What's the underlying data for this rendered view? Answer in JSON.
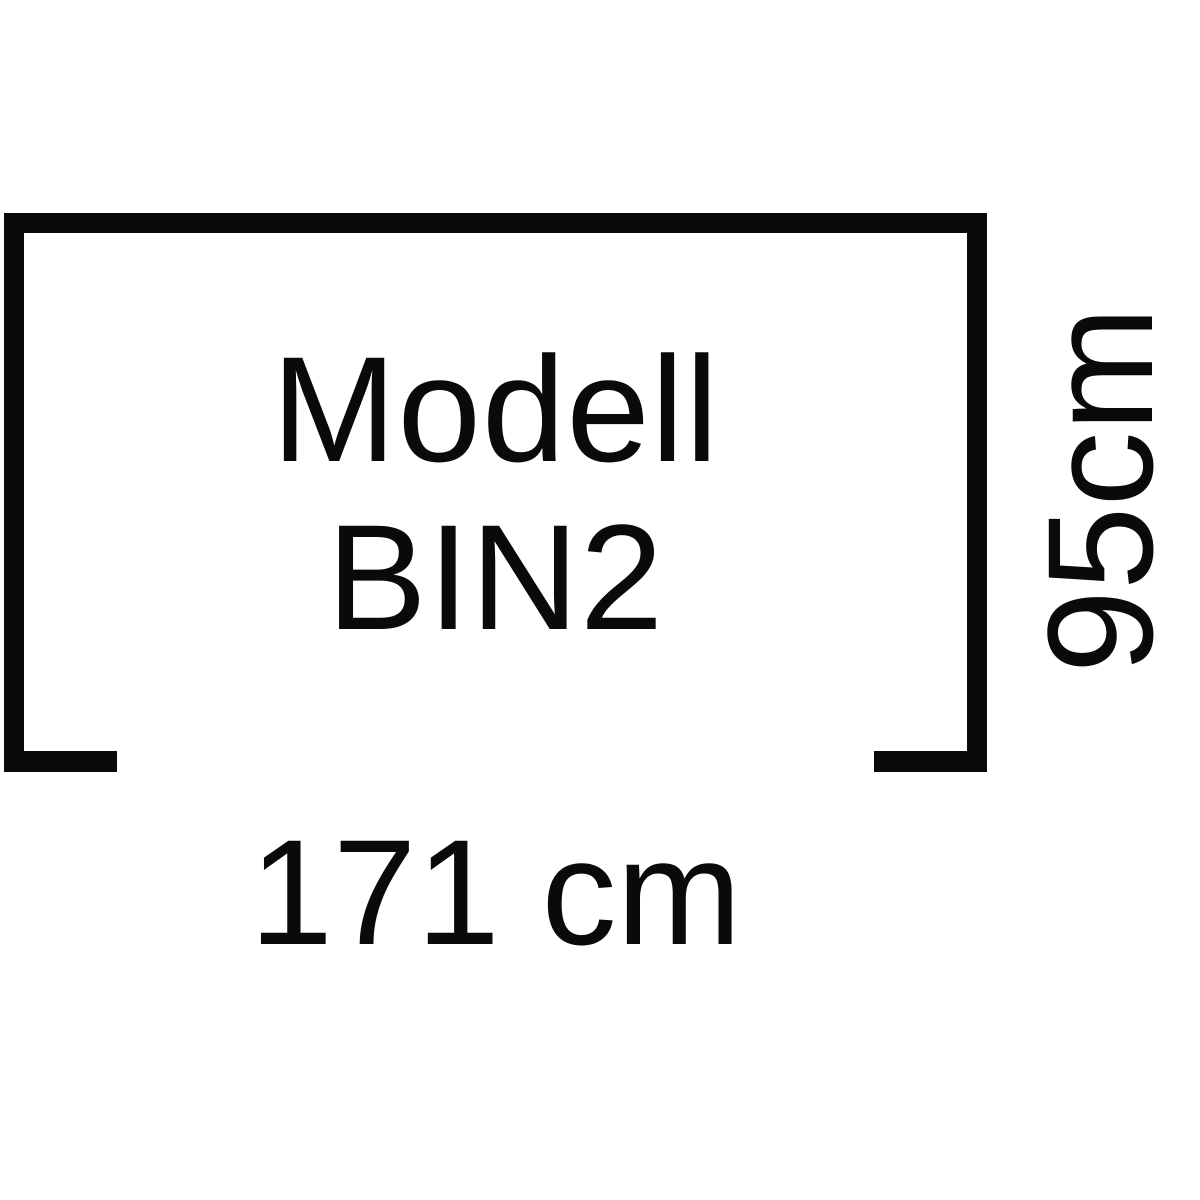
{
  "diagram": {
    "type": "product-dimension-diagram",
    "model_line1": "Modell",
    "model_line2": "BIN2",
    "width_label": "171 cm",
    "height_label": "95cm",
    "ink_color": "#0a0a0a",
    "background_color": "#ffffff"
  }
}
